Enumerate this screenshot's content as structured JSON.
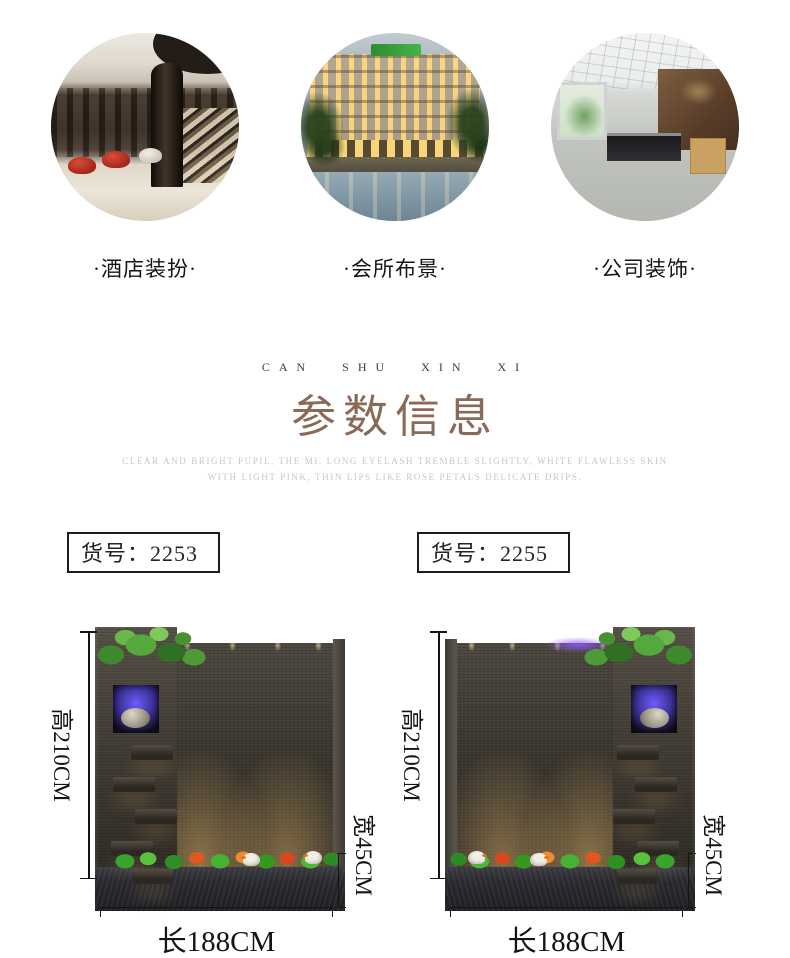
{
  "scenes": {
    "items": [
      {
        "label": "·酒店装扮·",
        "image": "hotel-lobby-photo"
      },
      {
        "label": "·会所布景·",
        "image": "club-resort-pool-photo"
      },
      {
        "label": "·公司装饰·",
        "image": "office-reception-photo"
      }
    ]
  },
  "section_header": {
    "eyebrow": "CAN SHU XIN XI",
    "title": "参数信息",
    "subtitle_line1": "CLEAR AND BRIGHT PUPIL, THE MI, LONG EYELASH TREMBLE SLIGHTLY, WHITE FLAWLESS SKIN",
    "subtitle_line2": "WITH LIGHT PINK, THIN LIPS LIKE ROSE PETALS DELICATE DRIPS.",
    "title_color": "#8a6a57",
    "subtitle_color": "#c9c6c2"
  },
  "products": [
    {
      "sku": "货号：2253",
      "dim_height": "高210CM",
      "dim_width": "宽45CM",
      "dim_length": "长188CM",
      "fountain_orientation": "tower-left"
    },
    {
      "sku": "货号：2255",
      "dim_height": "高210CM",
      "dim_width": "宽45CM",
      "dim_length": "长188CM",
      "fountain_orientation": "tower-right"
    }
  ]
}
